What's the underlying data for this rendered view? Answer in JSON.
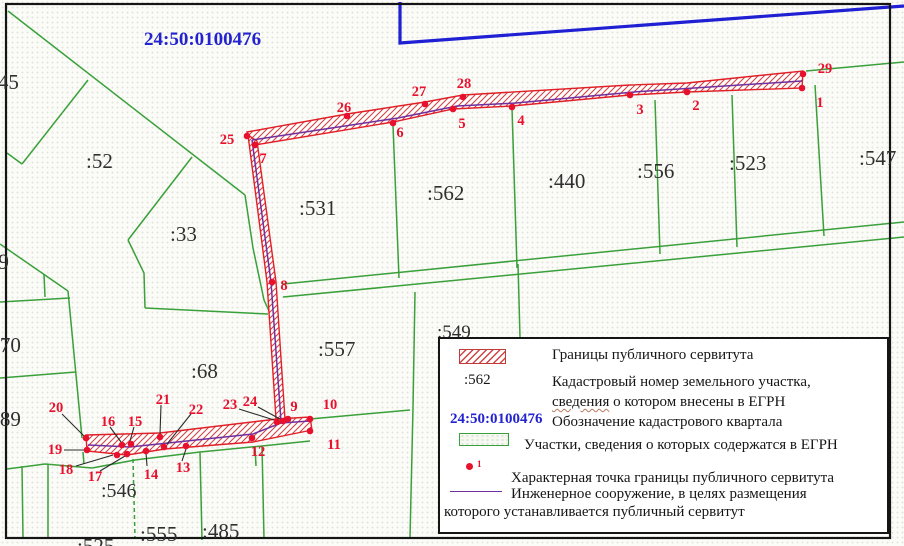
{
  "map": {
    "quarter_label": {
      "text": "24:50:0100476",
      "x": 144,
      "y": 45
    },
    "colors": {
      "green": "#3aa03a",
      "red": "#e11f26",
      "hatch": "#cf4545",
      "dot": "#e8112d",
      "purple": "#7030a0",
      "blue": "#1f1fd4",
      "frame": "#151515",
      "label": "#2f2f2f",
      "blue_label": "#2323cf",
      "leader": "#2a2a2a"
    },
    "frame": {
      "x": 6,
      "y": 4,
      "w": 884,
      "h": 534
    },
    "blue_boundary": "400,2 400,43 904,6",
    "green_lines": [
      {
        "pts": "8,11 245,195"
      },
      {
        "pts": "88,80 22,164"
      },
      {
        "pts": "7,153 22,164"
      },
      {
        "pts": "192,157 128,240"
      },
      {
        "pts": "128,240 144,273 145,308"
      },
      {
        "pts": "145,308 268,314"
      },
      {
        "pts": "245,195 253,248 264,300 269,311"
      },
      {
        "pts": "0,244 68,291"
      },
      {
        "pts": "68,291 82,438"
      },
      {
        "pts": "0,302 70,298"
      },
      {
        "pts": "0,378 76,372"
      },
      {
        "pts": "44,274 45,297"
      },
      {
        "pts": "7,469 45,464 92,468"
      },
      {
        "pts": "22,466 23,538"
      },
      {
        "pts": "48,464 48,538"
      },
      {
        "pts": "92,468 135,460 200,452 262,446 310,441"
      },
      {
        "pts": "255,447 256,466"
      },
      {
        "pts": "133,459 135,538",
        "dashed": true
      },
      {
        "pts": "200,452 202,540"
      },
      {
        "pts": "262,446 264,538"
      },
      {
        "pts": "83,452 84,464"
      },
      {
        "pts": "310,419 410,410"
      },
      {
        "pts": "415,292 413,408 410,538"
      },
      {
        "pts": "283,284 904,222"
      },
      {
        "pts": "283,297 904,237"
      },
      {
        "pts": "393,125 399,278"
      },
      {
        "pts": "512,108 517,268"
      },
      {
        "pts": "655,100 660,254"
      },
      {
        "pts": "732,95 737,247"
      },
      {
        "pts": "815,85 824,236"
      },
      {
        "pts": "806,71 904,62"
      },
      {
        "pts": "518,264 520,337"
      }
    ],
    "servitude_bands": [
      {
        "name": "top-band",
        "pts": "247,132 347,114 425,102 463,95 630,85 687,83 803,71 802,88 687,92 630,95 512,106 453,109 393,122 255,145"
      },
      {
        "name": "vertical-band",
        "pts": "248,135 267,282 276,419 285,419 276,282 257,141"
      },
      {
        "name": "bottom-band",
        "pts": "86,435 160,433 277,419 310,417 312,430 253,442 165,449 127,455 87,451"
      }
    ],
    "engineering_lines": [
      "252,140 398,118 457,106 516,103 634,92 802,81",
      "252,140 271,282 281,421",
      "88,445 130,447 253,434 281,423 310,421"
    ],
    "leaders": [
      "62,414 84,436",
      "64,450 84,450",
      "76,466 113,455",
      "100,471 125,456",
      "110,427 121,442",
      "134,427 130,441",
      "161,405 160,434",
      "191,414 167,444",
      "147,466 146,453",
      "182,461 186,449",
      "239,409 274,420",
      "258,407 280,419"
    ],
    "points": [
      {
        "n": "1",
        "x": 802,
        "y": 88,
        "lx": 820,
        "ly": 107
      },
      {
        "n": "2",
        "x": 687,
        "y": 92,
        "lx": 696,
        "ly": 110
      },
      {
        "n": "3",
        "x": 630,
        "y": 95,
        "lx": 640,
        "ly": 114
      },
      {
        "n": "4",
        "x": 512,
        "y": 107,
        "lx": 521,
        "ly": 125
      },
      {
        "n": "5",
        "x": 453,
        "y": 109,
        "lx": 462,
        "ly": 128
      },
      {
        "n": "6",
        "x": 393,
        "y": 123,
        "lx": 400,
        "ly": 137
      },
      {
        "n": "7",
        "x": 255,
        "y": 145,
        "lx": 263,
        "ly": 163
      },
      {
        "n": "8",
        "x": 272,
        "y": 282,
        "lx": 284,
        "ly": 290
      },
      {
        "n": "9",
        "x": 288,
        "y": 419,
        "lx": 294,
        "ly": 411
      },
      {
        "n": "10",
        "x": 310,
        "y": 419,
        "lx": 330,
        "ly": 409
      },
      {
        "n": "11",
        "x": 310,
        "y": 431,
        "lx": 334,
        "ly": 449
      },
      {
        "n": "12",
        "x": 252,
        "y": 438,
        "lx": 258,
        "ly": 456
      },
      {
        "n": "13",
        "x": 186,
        "y": 446,
        "lx": 183,
        "ly": 472
      },
      {
        "n": "14",
        "x": 146,
        "y": 451,
        "lx": 151,
        "ly": 479
      },
      {
        "n": "15",
        "x": 131,
        "y": 444,
        "lx": 135,
        "ly": 426
      },
      {
        "n": "16",
        "x": 122,
        "y": 445,
        "lx": 108,
        "ly": 426
      },
      {
        "n": "17",
        "x": 127,
        "y": 454,
        "lx": 95,
        "ly": 481
      },
      {
        "n": "18",
        "x": 117,
        "y": 455,
        "lx": 66,
        "ly": 474
      },
      {
        "n": "19",
        "x": 87,
        "y": 450,
        "lx": 55,
        "ly": 454
      },
      {
        "n": "20",
        "x": 86,
        "y": 438,
        "lx": 56,
        "ly": 412
      },
      {
        "n": "21",
        "x": 160,
        "y": 437,
        "lx": 163,
        "ly": 404
      },
      {
        "n": "22",
        "x": 164,
        "y": 447,
        "lx": 196,
        "ly": 414
      },
      {
        "n": "23",
        "x": 277,
        "y": 422,
        "lx": 230,
        "ly": 409
      },
      {
        "n": "24",
        "x": 283,
        "y": 421,
        "lx": 250,
        "ly": 406
      },
      {
        "n": "25",
        "x": 247,
        "y": 136,
        "lx": 227,
        "ly": 144
      },
      {
        "n": "26",
        "x": 347,
        "y": 116,
        "lx": 344,
        "ly": 112
      },
      {
        "n": "27",
        "x": 425,
        "y": 104,
        "lx": 419,
        "ly": 96
      },
      {
        "n": "28",
        "x": 463,
        "y": 97,
        "lx": 464,
        "ly": 88
      },
      {
        "n": "29",
        "x": 803,
        "y": 74,
        "lx": 825,
        "ly": 73
      }
    ],
    "parcel_labels": [
      {
        "text": ":45",
        "x": -8,
        "y": 89,
        "size": 21
      },
      {
        "text": "9",
        "x": -2,
        "y": 269,
        "size": 22
      },
      {
        "text": ":70",
        "x": -6,
        "y": 352,
        "size": 21
      },
      {
        "text": ":89",
        "x": -6,
        "y": 426,
        "size": 21
      },
      {
        "text": ":52",
        "x": 86,
        "y": 168,
        "size": 21
      },
      {
        "text": ":33",
        "x": 170,
        "y": 241,
        "size": 21
      },
      {
        "text": ":531",
        "x": 299,
        "y": 215,
        "size": 21
      },
      {
        "text": ":562",
        "x": 427,
        "y": 200,
        "size": 21
      },
      {
        "text": ":440",
        "x": 548,
        "y": 188,
        "size": 21
      },
      {
        "text": ":556",
        "x": 637,
        "y": 178,
        "size": 21
      },
      {
        "text": ":523",
        "x": 729,
        "y": 170,
        "size": 21
      },
      {
        "text": ":547",
        "x": 859,
        "y": 165,
        "size": 21
      },
      {
        "text": ":557",
        "x": 318,
        "y": 356,
        "size": 21
      },
      {
        "text": ":549",
        "x": 437,
        "y": 338,
        "size": 19
      },
      {
        "text": ":68",
        "x": 191,
        "y": 378,
        "size": 21
      },
      {
        "text": ":546",
        "x": 101,
        "y": 497,
        "size": 20
      },
      {
        "text": ":555",
        "x": 140,
        "y": 541,
        "size": 21
      },
      {
        "text": ":485",
        "x": 202,
        "y": 538,
        "size": 21
      },
      {
        "text": ":525",
        "x": 77,
        "y": 553,
        "size": 21
      }
    ]
  },
  "legend": {
    "row1_label": "Границы публичного сервитута",
    "row2_key": ":562",
    "row2_line1": "Кадастровый номер  земельного участка,",
    "row2_line2_word": "сведения",
    "row2_line2_rest": " о котором внесены в ЕГРН",
    "row3_key": "24:50:0100476",
    "row3_label": "Обозначение кадастрового квартала",
    "row4_label": "Участки,  сведения о которых содержатся в  ЕГРН",
    "row5_marker_sub": "1",
    "row5_label": "Характерная точка границы публичного сервитута",
    "row6_label": "Инженерное сооружение, в целях размещения",
    "row7_label": "которого устанавливается публичный сервитут"
  }
}
